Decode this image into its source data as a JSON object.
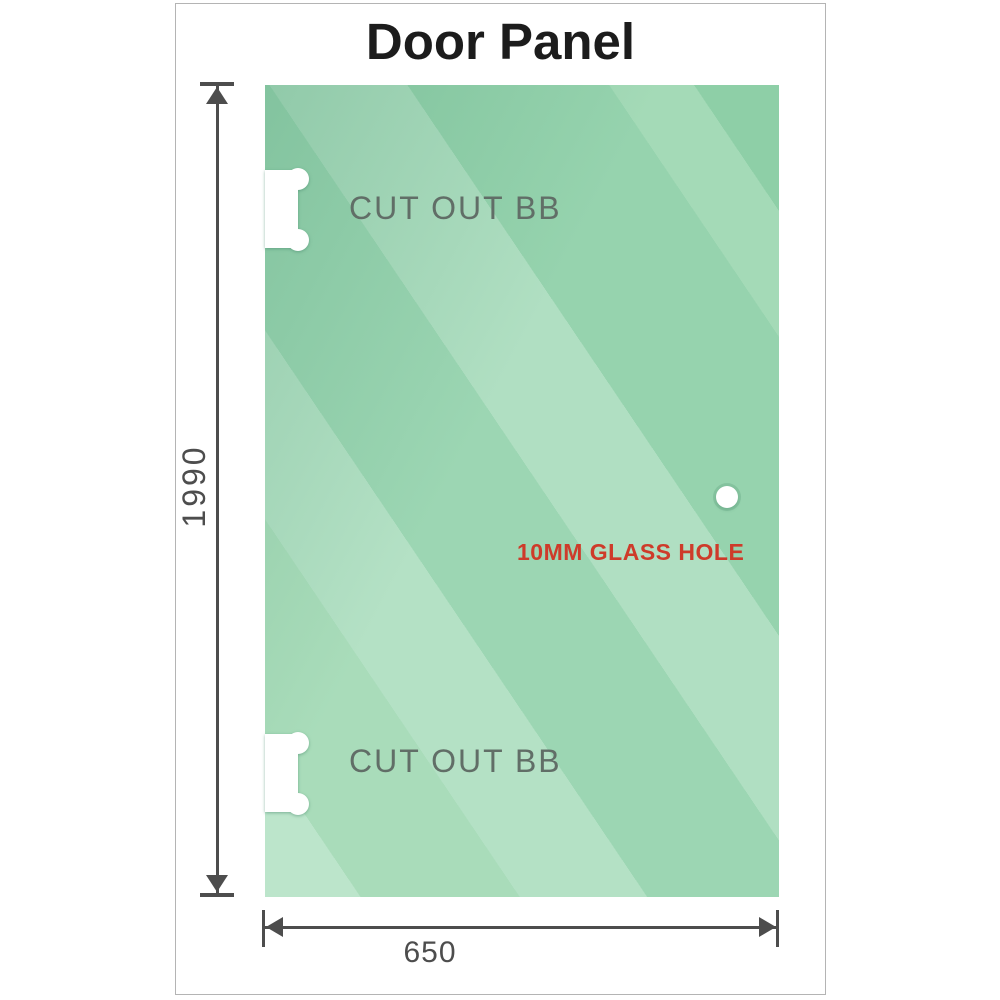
{
  "title": "Door Panel",
  "panel": {
    "kind": "glass door panel drawing",
    "cutouts": [
      {
        "label": "CUT OUT BB",
        "position": "top-left"
      },
      {
        "label": "CUT OUT BB",
        "position": "bottom-left"
      }
    ],
    "hole": {
      "label": "10MM GLASS HOLE"
    }
  },
  "dimensions": {
    "height": {
      "value": "1990",
      "orientation": "vertical"
    },
    "width": {
      "value": "650",
      "orientation": "horizontal"
    }
  },
  "colors": {
    "glass_dark": "#8ecfa7",
    "glass_mid": "#9cd6b3",
    "glass_light": "#bce5cb",
    "dimension": "#4d4d4d",
    "cutout_label": "#616e67",
    "hole_label": "#ce3b2a",
    "title": "#1c1c1c",
    "frame_border": "#b4b4b4"
  }
}
